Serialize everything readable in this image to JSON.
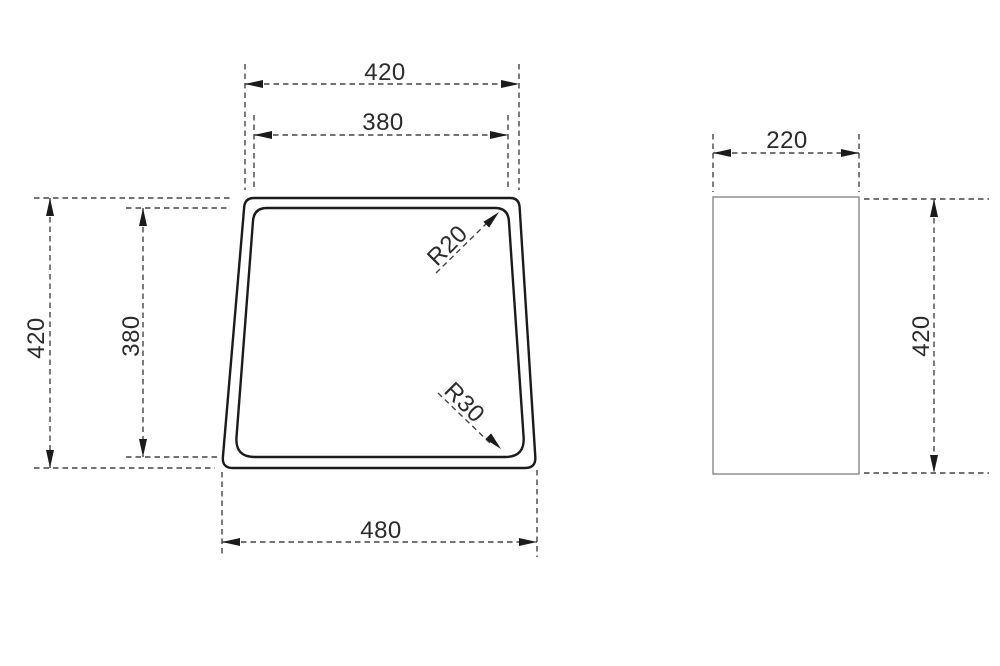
{
  "views": {
    "top_view": {
      "dim_top_outer": "420",
      "dim_top_inner": "380",
      "dim_left_outer": "420",
      "dim_left_inner": "380",
      "dim_bottom": "480",
      "radius_top_corner": "R20",
      "radius_bottom_corner": "R30"
    },
    "side_view": {
      "dim_width": "220",
      "dim_height": "420"
    }
  },
  "colors": {
    "outline": "#1b1b1b",
    "side_outline": "#909090",
    "dimension_line": "#454545",
    "arrow": "#1b1b1b",
    "label_text": "#2b2b2b",
    "background": "#ffffff"
  }
}
